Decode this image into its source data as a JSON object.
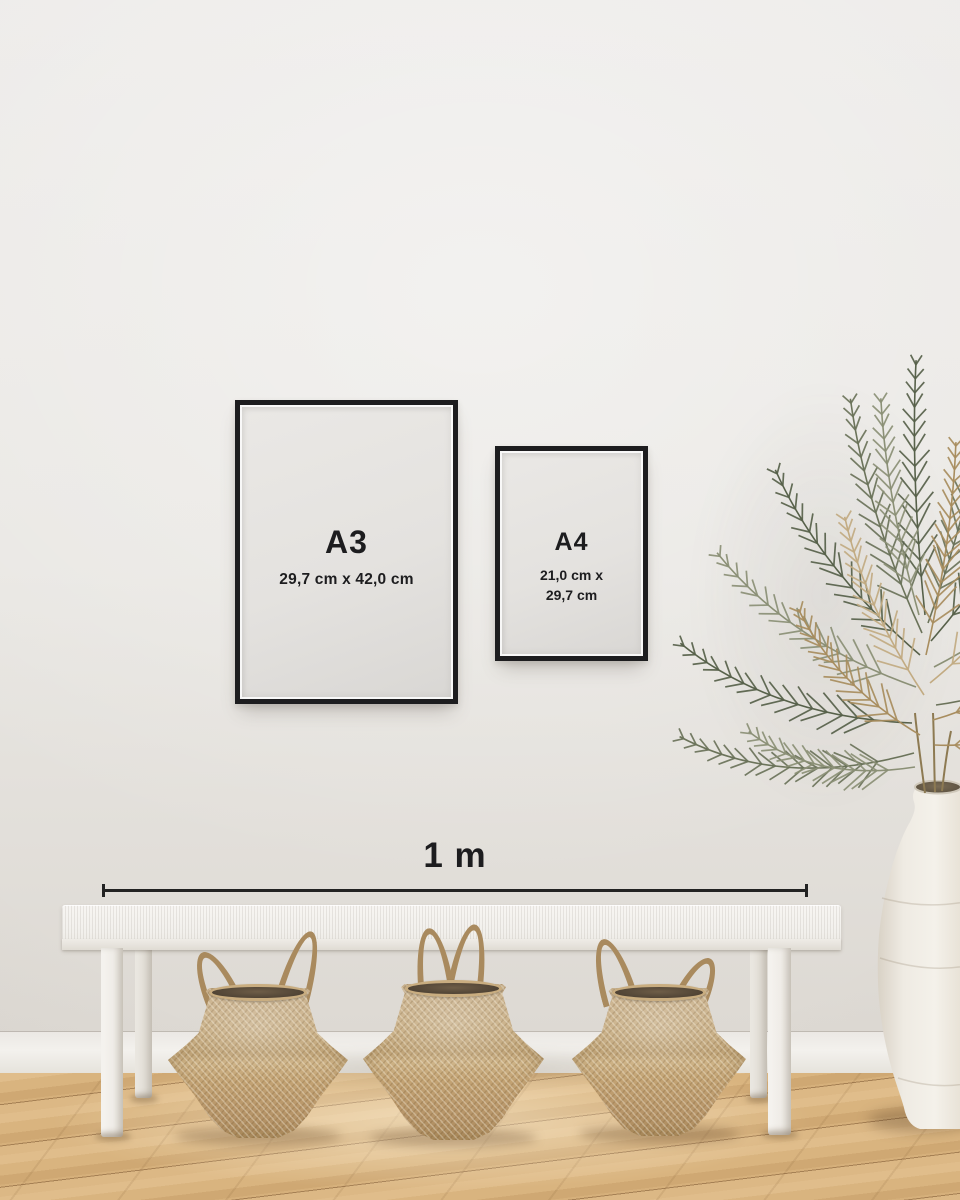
{
  "frames": [
    {
      "label": "A3",
      "dimensions": "29,7 cm x 42,0 cm"
    },
    {
      "label": "A4",
      "dimensions_line1": "21,0 cm x",
      "dimensions_line2": "29,7 cm"
    }
  ],
  "scale_bar": {
    "label": "1 m"
  },
  "objects": {
    "visible": [
      "framed-print-a3",
      "framed-print-a4",
      "scale-bar",
      "white-bench",
      "seagrass-basket",
      "seagrass-basket",
      "seagrass-basket",
      "dried-palm-plant",
      "white-urn-vase",
      "wood-floor"
    ],
    "basket_count": 3
  },
  "palette": {
    "wall": "#e9e7e3",
    "baseboard": "#f1efeb",
    "floor-mid": "#d4ad79",
    "frame-border": "#1d1d1f",
    "frame-paper": "#e4e2df",
    "ink": "#1d1d1f",
    "bench-white": "#f2f0ec",
    "basket-mid": "#c2a478",
    "basket-inner": "#57493a",
    "vase-light": "#f0ece6",
    "leaf-dark": "#57614a",
    "leaf-mid": "#6b735a",
    "leaf-light": "#8b9076",
    "leaf-dry": "#a88d5e",
    "leaf-dry-light": "#c2ab82"
  }
}
